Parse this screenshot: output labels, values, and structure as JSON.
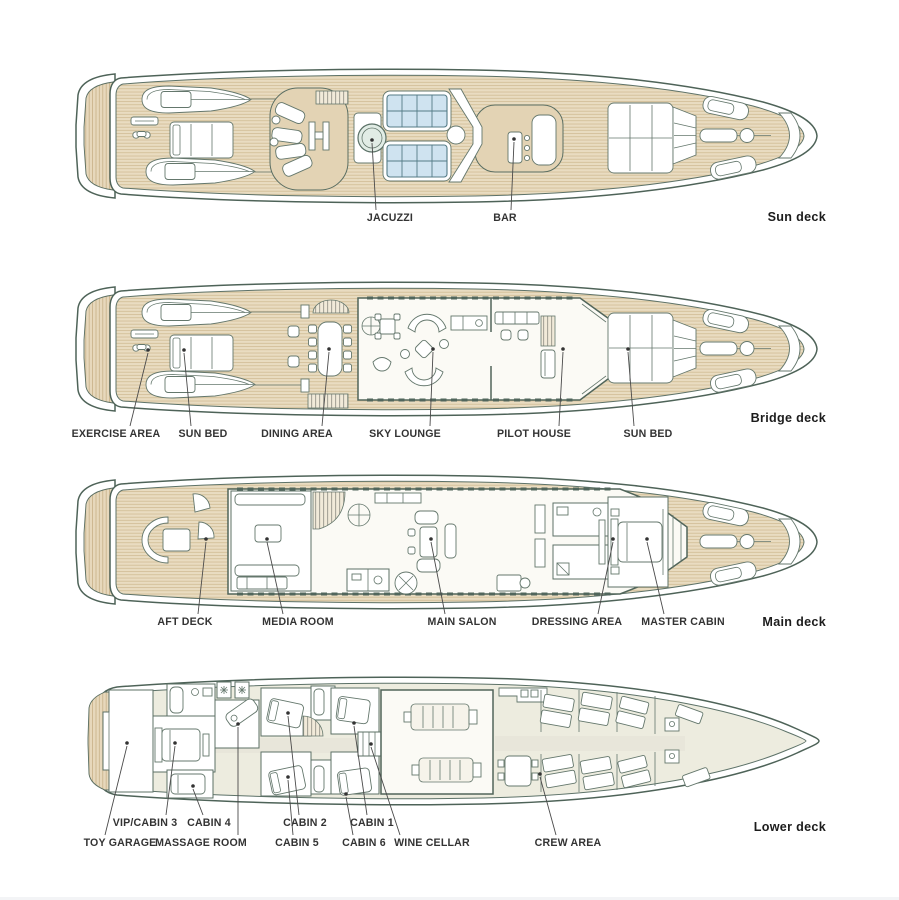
{
  "title": "Yacht deck plans",
  "colors": {
    "outline": "#4e6358",
    "teak_plank": "#e9dcc1",
    "plank_line": "#c9b48c",
    "raised_pod": "#e3d3b4",
    "skylight_blue": "#cfe3f0",
    "interior_floor": "#f3f1e8",
    "lower_deck_fill": "#edecdf",
    "label_text": "#333333",
    "deck_name_text": "#1c1c1c"
  },
  "decks": [
    {
      "name": "Sun deck",
      "labels": [
        {
          "text": "JACUZZI"
        },
        {
          "text": "BAR"
        }
      ]
    },
    {
      "name": "Bridge deck",
      "labels": [
        {
          "text": "EXERCISE AREA"
        },
        {
          "text": "SUN BED"
        },
        {
          "text": "DINING AREA"
        },
        {
          "text": "SKY LOUNGE"
        },
        {
          "text": "PILOT HOUSE"
        },
        {
          "text": "SUN BED"
        }
      ]
    },
    {
      "name": "Main deck",
      "labels": [
        {
          "text": "AFT DECK"
        },
        {
          "text": "MEDIA ROOM"
        },
        {
          "text": "MAIN SALON"
        },
        {
          "text": "DRESSING AREA"
        },
        {
          "text": "MASTER CABIN"
        }
      ]
    },
    {
      "name": "Lower deck",
      "labels": [
        {
          "text": "VIP/CABIN 3"
        },
        {
          "text": "CABIN 4"
        },
        {
          "text": "CABIN 2"
        },
        {
          "text": "CABIN 1"
        },
        {
          "text": "TOY GARAGE"
        },
        {
          "text": "MASSAGE ROOM"
        },
        {
          "text": "CABIN 5"
        },
        {
          "text": "CABIN 6"
        },
        {
          "text": "WINE CELLAR"
        },
        {
          "text": "CREW AREA"
        }
      ]
    }
  ]
}
